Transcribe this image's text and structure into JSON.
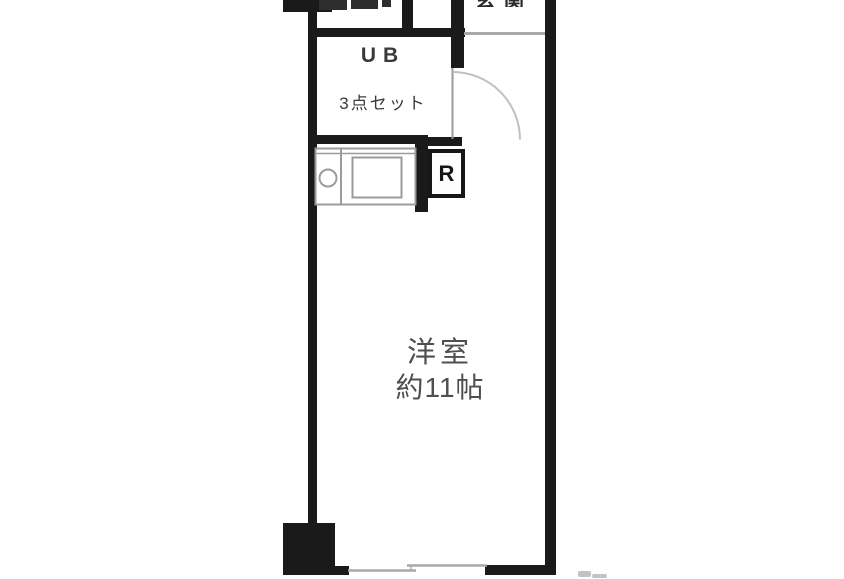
{
  "floorplan": {
    "rooms": {
      "unit_bath": {
        "line1": "UB",
        "line2": "3点セット"
      },
      "main_room": {
        "line1": "洋室",
        "line2": "約11帖"
      },
      "refrigerator": {
        "label": "R"
      },
      "entrance": {
        "label_cutoff": "玄関"
      }
    },
    "colors": {
      "wall": "#1a1a1a",
      "cutoff_fixture": "#2e2e2e",
      "fixture_stroke": "#9b9b9b",
      "door_leaf": "#9a9a9a",
      "door_arc": "#c0c0c0",
      "step_line": "#a8a8a8",
      "window_line": "#a8a8a8",
      "faint_mark": "#b5b5b5",
      "text": "#4f4f4f",
      "background": "#ffffff"
    }
  }
}
